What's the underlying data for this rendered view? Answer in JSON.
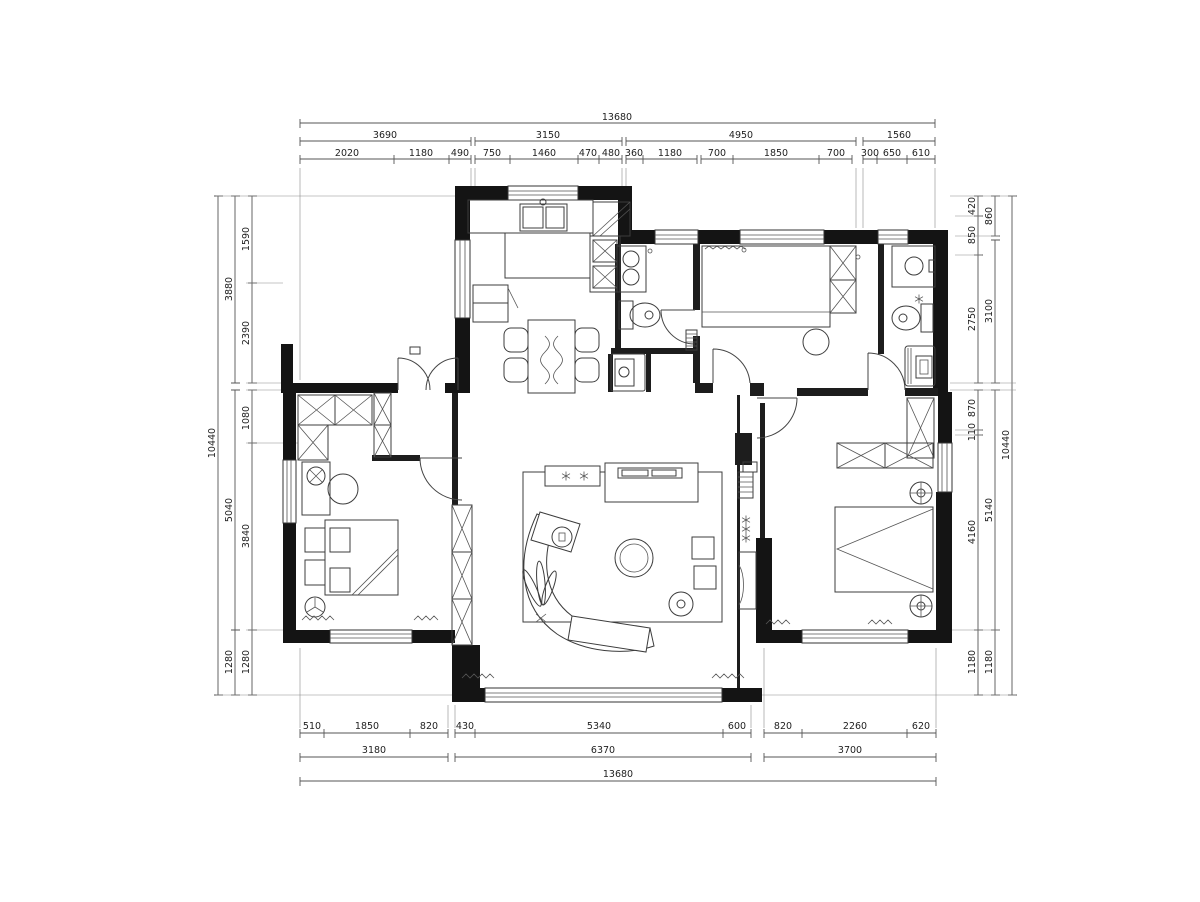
{
  "drawing": {
    "type": "apartment-floor-plan",
    "units": "mm",
    "line_color": "#3c3c3c",
    "wall_color": "#141414",
    "background": "#ffffff"
  },
  "dims": {
    "top": {
      "row1": [
        "13680"
      ],
      "row2": [
        "3690",
        "3150",
        "4950",
        "1560"
      ],
      "row3": [
        "2020",
        "1180",
        "490",
        "750",
        "1460",
        "470",
        "480",
        "360",
        "1180",
        "700",
        "1850",
        "700",
        "300",
        "650",
        "610"
      ]
    },
    "bottom": {
      "row1": [
        "510",
        "1850",
        "820",
        "430",
        "5340",
        "600",
        "820",
        "2260",
        "620"
      ],
      "row2": [
        "3180",
        "6370",
        "3700"
      ],
      "row3": [
        "13680"
      ]
    },
    "left": {
      "inner": [
        "1590",
        "2390",
        "1080",
        "3840",
        "1280"
      ],
      "middle": [
        "3880",
        "5040",
        "1280"
      ],
      "outer": [
        "10440"
      ]
    },
    "right": {
      "inner": [
        "420",
        "850",
        "2750",
        "870",
        "110",
        "4160",
        "1180"
      ],
      "middle": [
        "860",
        "3100",
        "5140",
        "1180"
      ],
      "outer": [
        "10440"
      ]
    }
  }
}
